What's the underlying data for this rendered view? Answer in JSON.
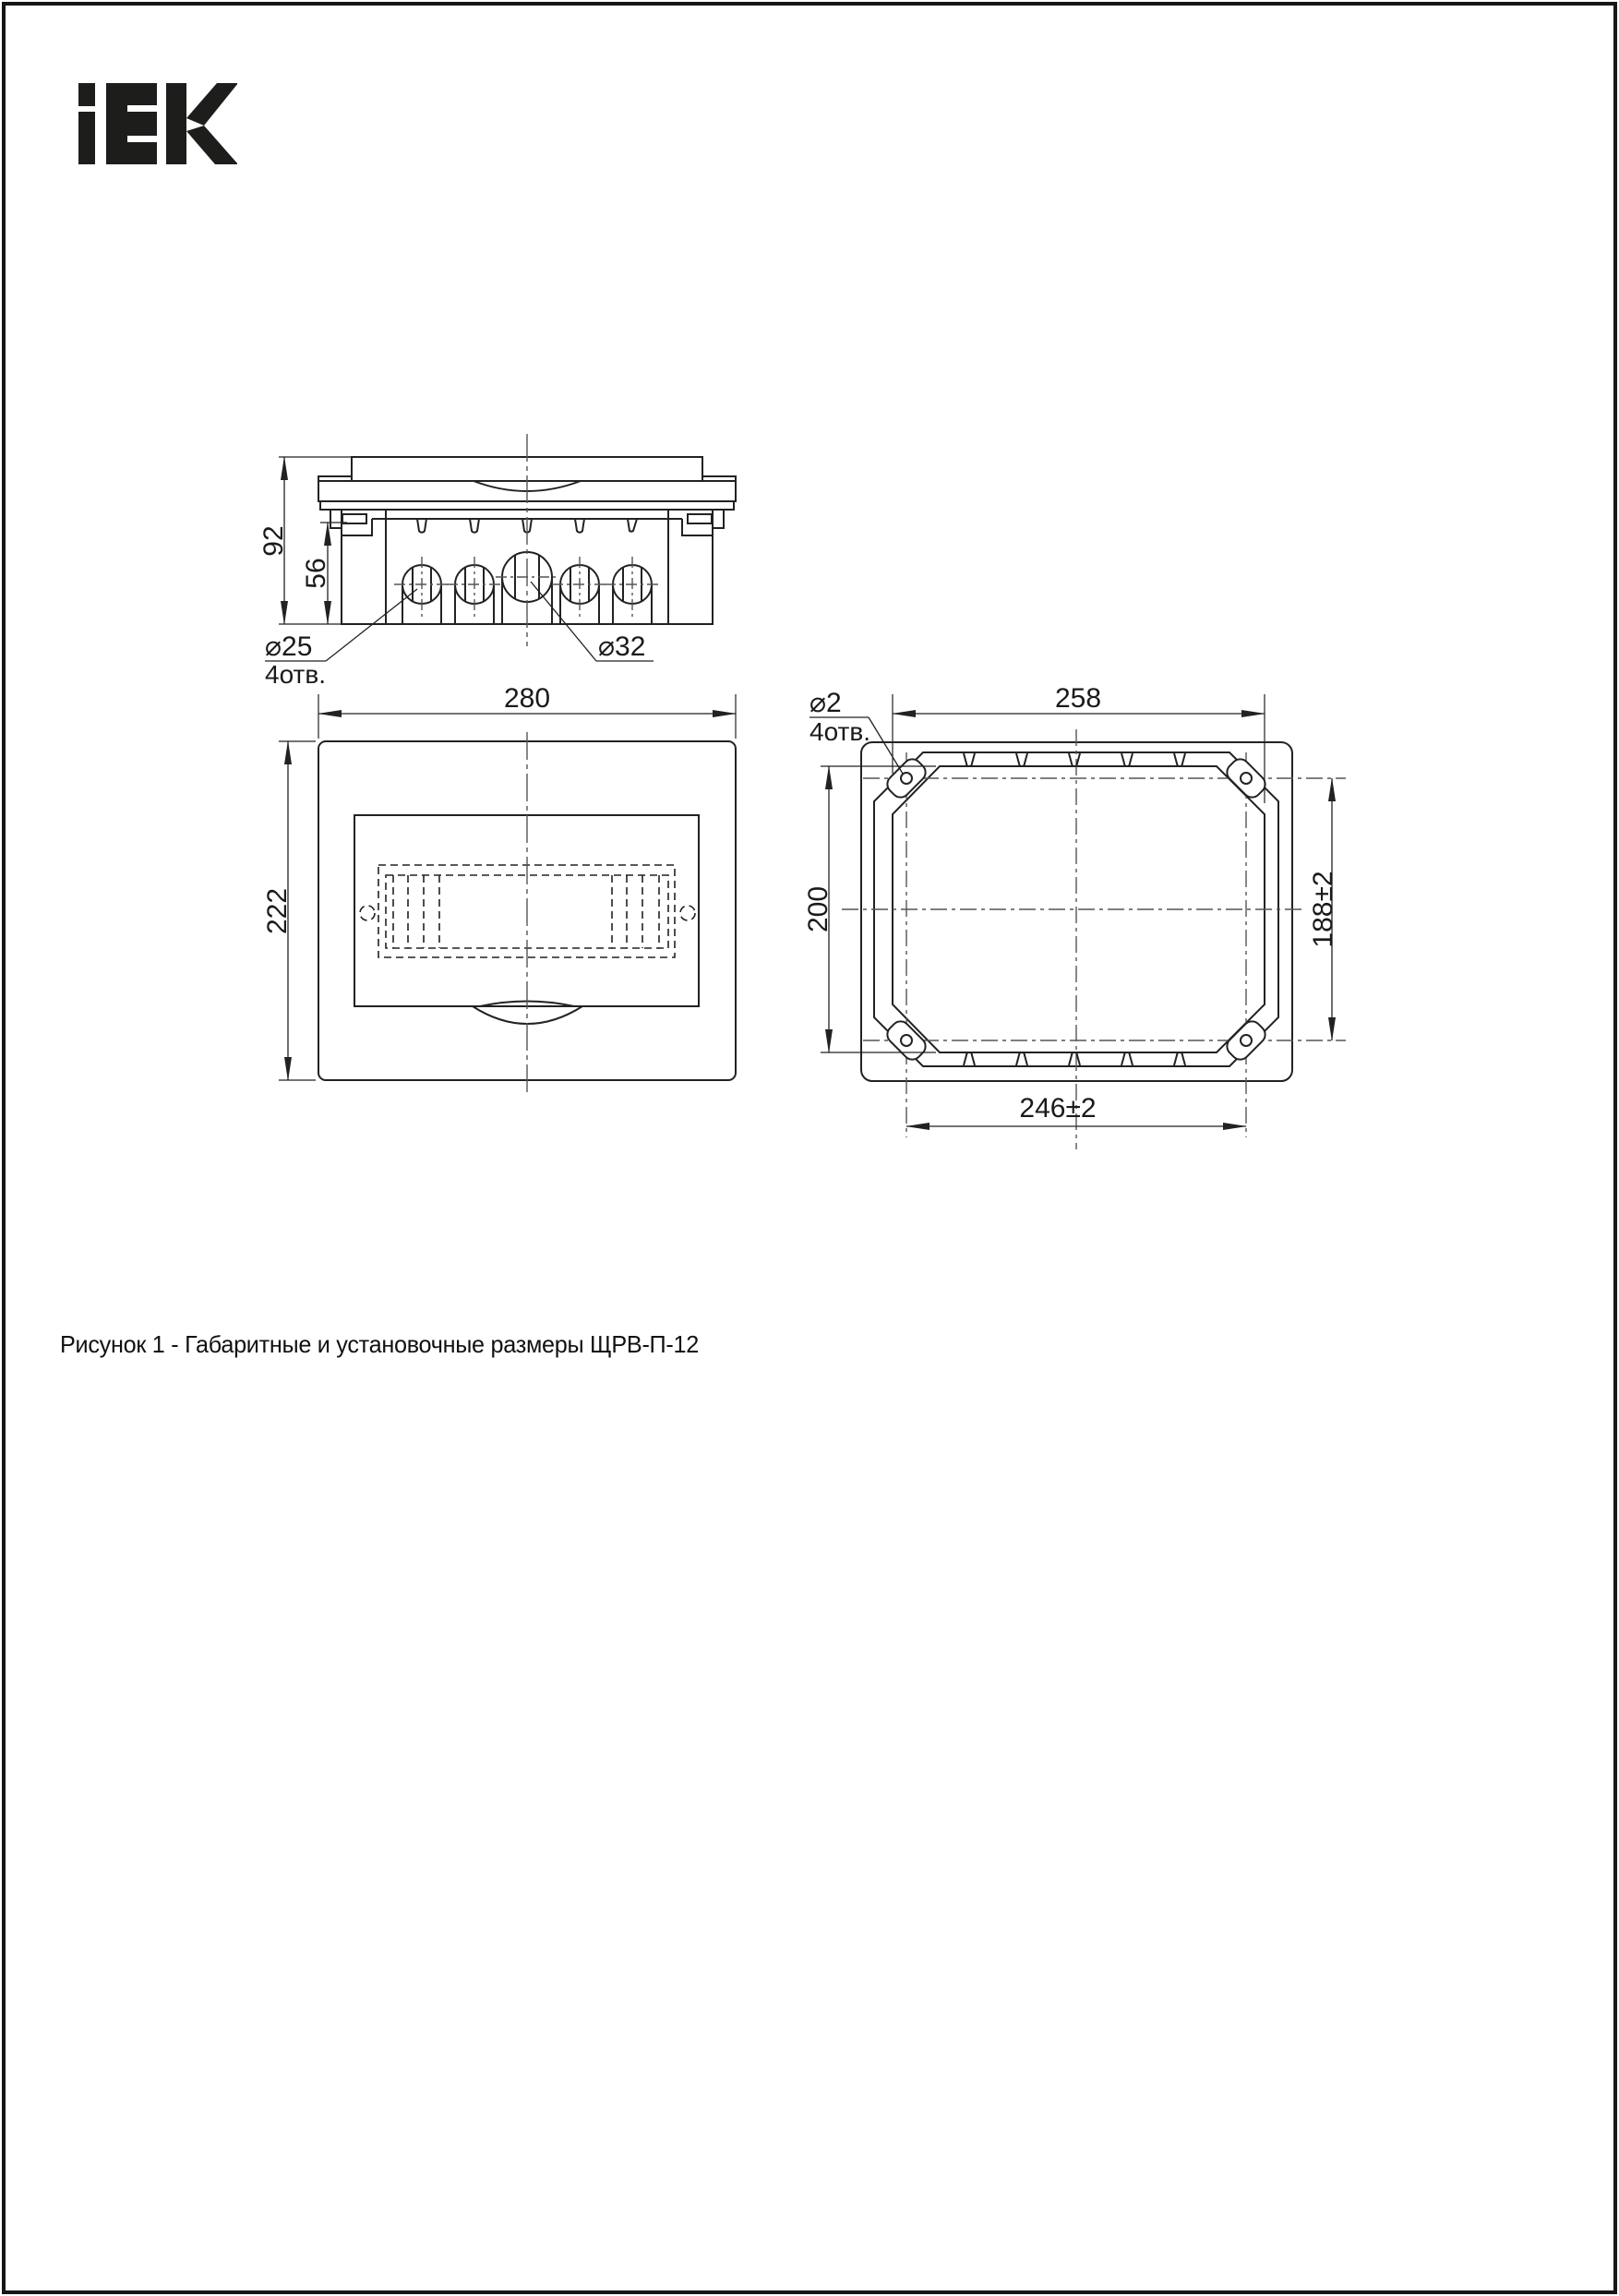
{
  "page": {
    "background": "#ffffff",
    "border_color": "#161616"
  },
  "logo": {
    "brand": "IEK",
    "color": "#1d1d1b"
  },
  "drawing": {
    "line_color": "#222222",
    "centerline_color": "#555555",
    "top_view": {
      "overall_height": "92",
      "body_height": "56",
      "small_hole_dia": "⌀25",
      "small_hole_count": "4отв.",
      "large_hole_dia": "⌀32"
    },
    "front_view": {
      "width": "280",
      "height": "222"
    },
    "rear_view": {
      "mount_hole_dia": "⌀2",
      "mount_hole_count": "4отв.",
      "opening_width": "258",
      "opening_height": "200",
      "mount_spacing_v": "188±2",
      "mount_spacing_h": "246±2"
    }
  },
  "caption": {
    "text": "Рисунок 1 - Габаритные и установочные размеры ЩРВ-П-12"
  }
}
